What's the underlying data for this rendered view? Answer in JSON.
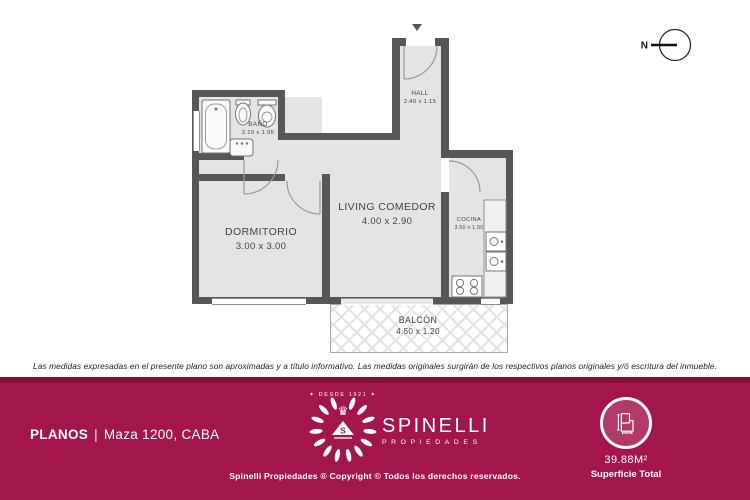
{
  "plan": {
    "compass_label": "N",
    "rooms": [
      {
        "name": "HALL",
        "dims": "2.40 x 1.15"
      },
      {
        "name": "BAÑO",
        "dims": "2.10 x 1.95"
      },
      {
        "name": "DORMITORIO",
        "dims": "3.00 x 3.00"
      },
      {
        "name": "LIVING COMEDOR",
        "dims": "4.00 x 2.90"
      },
      {
        "name": "COCINA",
        "dims": "3.50 x 1.50"
      },
      {
        "name": "BALCÓN",
        "dims": "4.50 x 1.20"
      }
    ]
  },
  "disclaimer": "Las medidas expresadas en el presente plano son aproximadas y a título informativo. Las medidas originales surgirán de los respectivos planos originales y/ó escritura del inmueble.",
  "footer": {
    "section_label": "PLANOS",
    "separator": "|",
    "address": "Maza 1200, CABA",
    "brand": {
      "since": "✦ DESDE 1921 ✦",
      "name": "SPINELLI",
      "subtitle": "PROPIEDADES",
      "emblem_initial": "S",
      "crown_icon": "♛"
    },
    "copyright": "Spinelli Propiedades ® Copyright © Todos los derechos reservados.",
    "surface_value": "39.88M²",
    "surface_label": "Superficie Total"
  },
  "colors": {
    "footer_bg": "#A2164A",
    "footer_band": "#7E1134",
    "wall": "#575757",
    "floor": "#E4E4E4"
  }
}
